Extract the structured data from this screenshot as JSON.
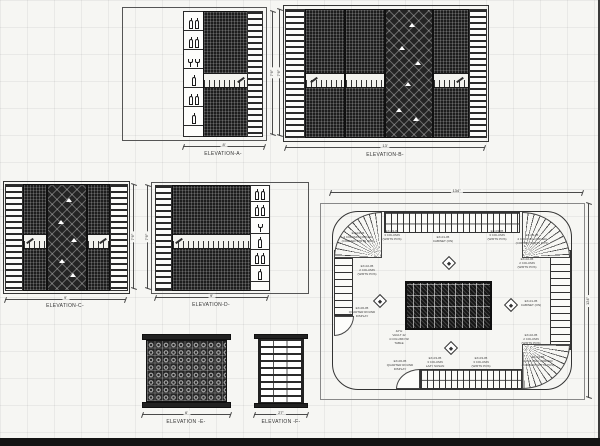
{
  "sheet": {
    "background": "#f6f6f3",
    "grid_color": "rgba(0,0,0,0.05)",
    "ink": "#2a2a2a",
    "paper_edge_color": "#141414"
  },
  "icons": {
    "bottle": "wine-bottle-icon",
    "glass": "wine-glass-icon",
    "diamond_marker": "lazy-susan-marker"
  },
  "elevations": {
    "A": {
      "label": "ELEVATION-A-",
      "width_dim": "8'",
      "height_dim": "7'6\""
    },
    "B": {
      "label": "ELEVATION-B-",
      "width_dim": "13'",
      "height_dim": "7'6\""
    },
    "C": {
      "label": "ELEVATION-C-",
      "width_dim": "9'",
      "height_dim": "7'6\""
    },
    "D": {
      "label": "ELEVATION-D-",
      "width_dim": "9'",
      "height_dim": "7'6\""
    },
    "E": {
      "label": "ELEVATION -E-",
      "width_dim": "6'"
    },
    "F": {
      "label": "ELEVATION -F-",
      "width_dim": "27\""
    }
  },
  "plan": {
    "width_dim": "134\"",
    "height_dim": "124\"",
    "annotations": [
      {
        "text": "EX-04-05\n4 COLUMN CORNER\n(CORNER W/RTN POS)"
      },
      {
        "text": "EX-03-05\n3 COLUMN\n(W/RTN POS)"
      },
      {
        "text": "EX-01-05\nCABINET (ON)"
      },
      {
        "text": "EX-03-05\n3 COLUMN\n(W/RTN POS)"
      },
      {
        "text": "EX-04-05\n4 COLUMN CORNER\n(CORNER W/RTN POS)"
      },
      {
        "text": "EX-02-05\n2 COLUMN\n(W/RTN POS)"
      },
      {
        "text": "EX-02-05\n2 COLUMN\n(W/RTN POS)"
      },
      {
        "text": "EX-06-05\nQUARTER ROUND\nDISPLAY"
      },
      {
        "text": "EX-01-05\nCABINET (ON)"
      },
      {
        "text": "EX-02-05\n2 COLUMN\n(W/RTN POS)"
      },
      {
        "text": "EX-04-05\n4 COLUMN CORNER\n(CORNER W/RTN POS)"
      },
      {
        "text": "EX-06-05\nQUARTER ROUND\nDISPLAY"
      },
      {
        "text": "EX-03-05\n3 COLUMN\nLAZY SUSAN"
      },
      {
        "text": "EX-03-05\n3 COLUMN\n(W/RTN POS)"
      },
      {
        "text": "42\"H\nVAULT 42\n4 COLUMN W/\nTABLE"
      }
    ]
  }
}
